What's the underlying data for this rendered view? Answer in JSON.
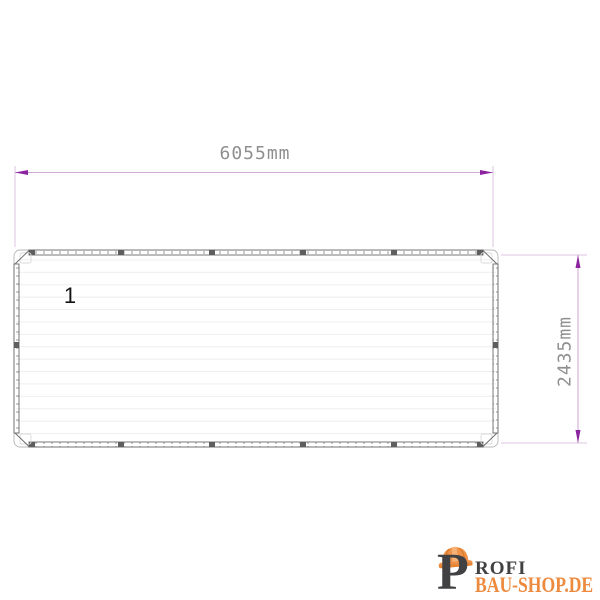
{
  "drawing": {
    "title": "container-top-view",
    "part_label": "1",
    "width_dimension": "6055mm",
    "height_dimension": "2435mm",
    "colors": {
      "dimension_line": "#cfa6d4",
      "dimension_extension_line": "#dcc3e2",
      "dimension_arrow": "#8c23a0",
      "dimension_text": "#8f8f8f",
      "outline_gray": "#6a6a6a",
      "tick_gray": "#9a9a9a",
      "panel_line_gray": "#ececec"
    }
  },
  "logo": {
    "letter": "P",
    "line1": "ROFI",
    "line2": "BAU-SHOP.DE",
    "icon": "hard-hat-icon",
    "colors": {
      "text_dark": "#414042",
      "text_orange": "#ee8a3d",
      "hat_orange": "#ef9247",
      "hat_highlight": "#f6b176",
      "hat_shadow": "#d8782a"
    }
  }
}
